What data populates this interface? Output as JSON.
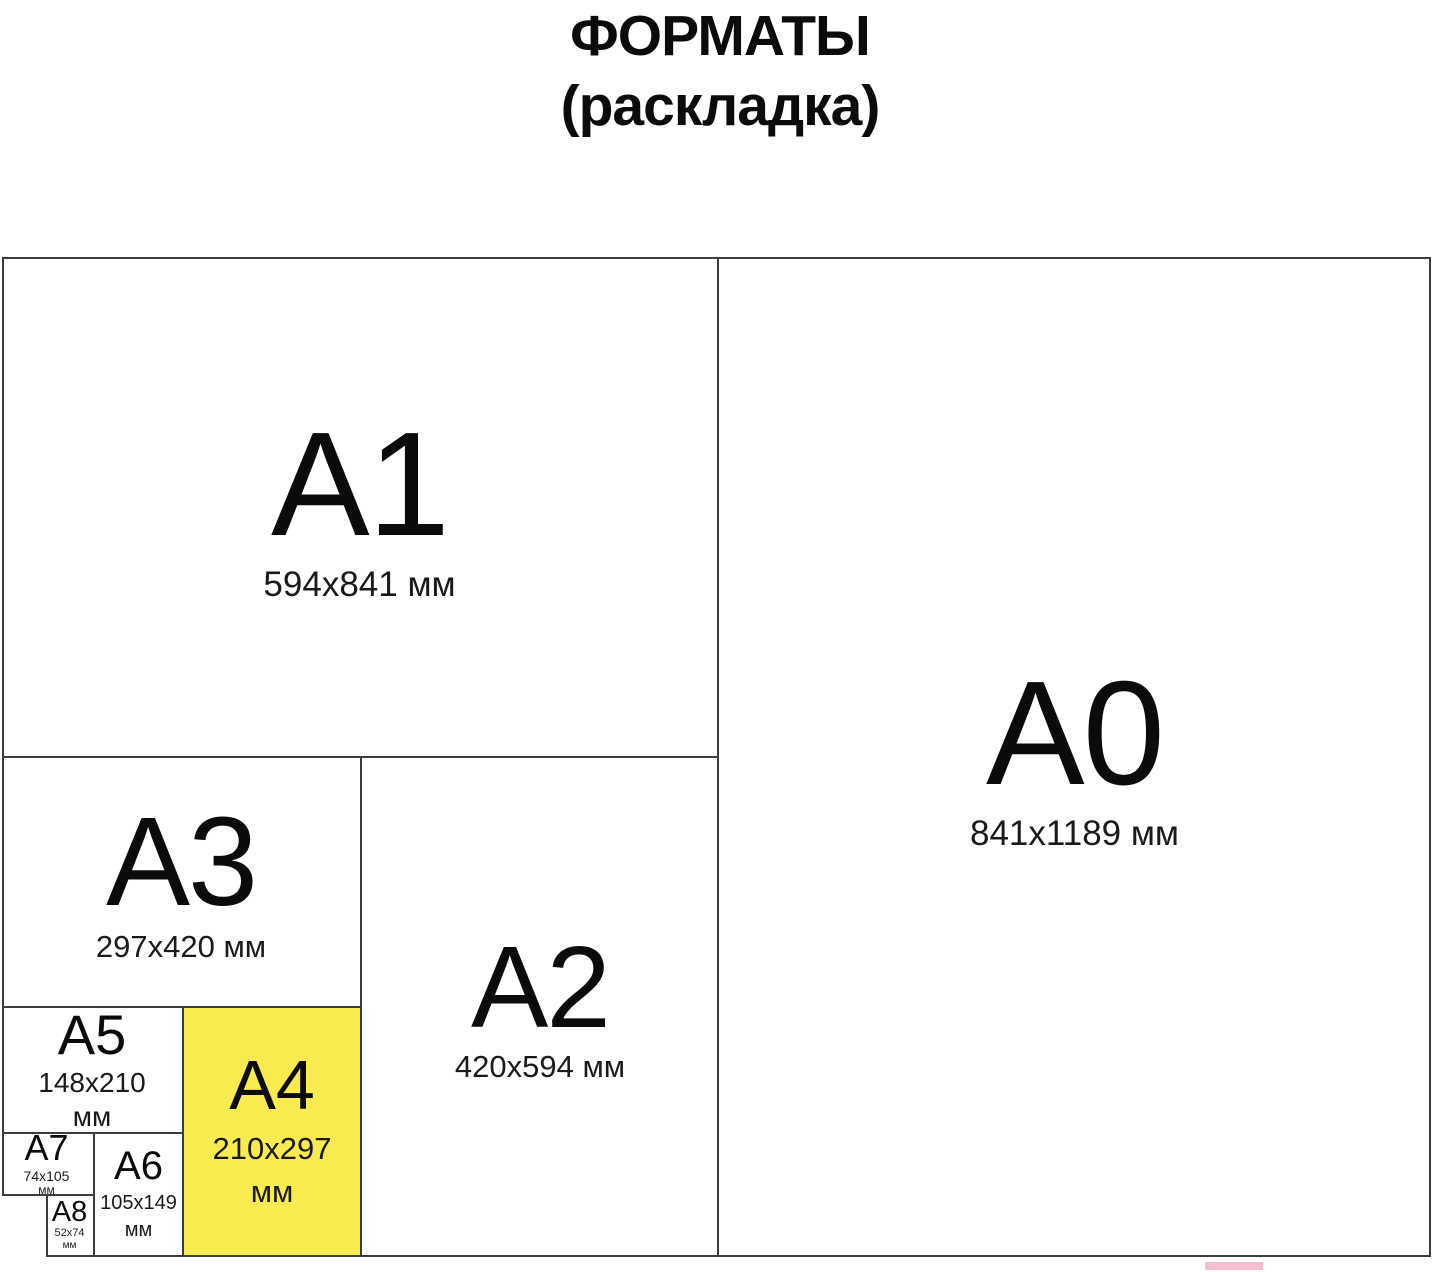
{
  "title": {
    "line1": "ФОРМАТЫ",
    "line2": "(раскладка)"
  },
  "colors": {
    "highlight_yellow": "#F7EB4F",
    "grid_line": "#3D3D3D",
    "text": "#0B0B0B",
    "pink_strip": "#F6BDCF",
    "background": "#FFFFFF"
  },
  "formats": {
    "a0": {
      "label": "A0",
      "dims": "841x1189 мм"
    },
    "a1": {
      "label": "A1",
      "dims": "594x841 мм"
    },
    "a2": {
      "label": "A2",
      "dims": "420x594 мм"
    },
    "a3": {
      "label": "A3",
      "dims": "297x420 мм"
    },
    "a4": {
      "label": "A4",
      "dims1": "210x297",
      "dims2": "мм",
      "highlighted": true
    },
    "a5": {
      "label": "A5",
      "dims1": "148x210",
      "dims2": "мм"
    },
    "a6": {
      "label": "A6",
      "dims1": "105x149",
      "dims2": "мм"
    },
    "a7": {
      "label": "A7",
      "dims1": "74x105",
      "dims2": "мм"
    },
    "a8": {
      "label": "A8",
      "dims1": "52x74",
      "dims2": "мм"
    }
  }
}
